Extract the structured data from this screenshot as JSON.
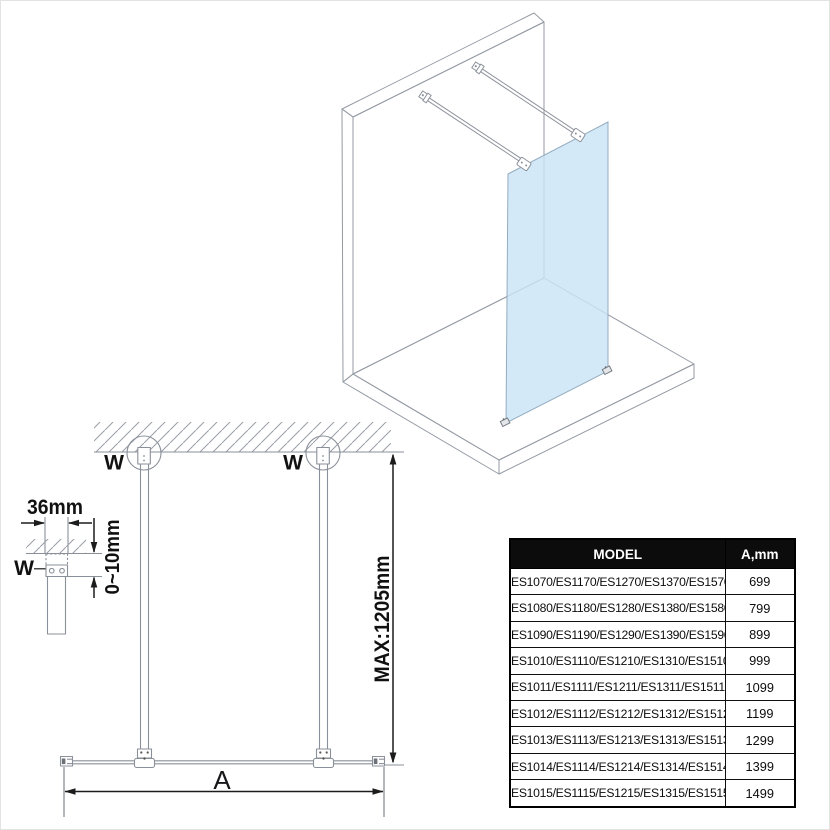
{
  "diagram": {
    "labels": {
      "wall_marker": "W",
      "bracket_width": "36mm",
      "adjustment_range": "0~10mm",
      "max_bar_length": "MAX:1205mm",
      "glass_width": "A"
    },
    "colors": {
      "glass_fill": "#CBE4F6",
      "object_line_gray": "#8A9099",
      "dimension_black": "#1C1C1C",
      "table_header_bg": "#0C0C0C",
      "table_header_text": "#FFFFFF"
    }
  },
  "table": {
    "columns": [
      "MODEL",
      "A,mm"
    ],
    "rows": [
      {
        "model": "ES1070/ES1170/ES1270/ES1370/ES1570",
        "a_mm": "699"
      },
      {
        "model": "ES1080/ES1180/ES1280/ES1380/ES1580",
        "a_mm": "799"
      },
      {
        "model": "ES1090/ES1190/ES1290/ES1390/ES1590",
        "a_mm": "899"
      },
      {
        "model": "ES1010/ES1110/ES1210/ES1310/ES1510",
        "a_mm": "999"
      },
      {
        "model": "ES1011/ES1111/ES1211/ES1311/ES1511",
        "a_mm": "1099"
      },
      {
        "model": "ES1012/ES1112/ES1212/ES1312/ES1512",
        "a_mm": "1199"
      },
      {
        "model": "ES1013/ES1113/ES1213/ES1313/ES1513",
        "a_mm": "1299"
      },
      {
        "model": "ES1014/ES1114/ES1214/ES1314/ES1514",
        "a_mm": "1399"
      },
      {
        "model": "ES1015/ES1115/ES1215/ES1315/ES1515",
        "a_mm": "1499"
      }
    ]
  }
}
